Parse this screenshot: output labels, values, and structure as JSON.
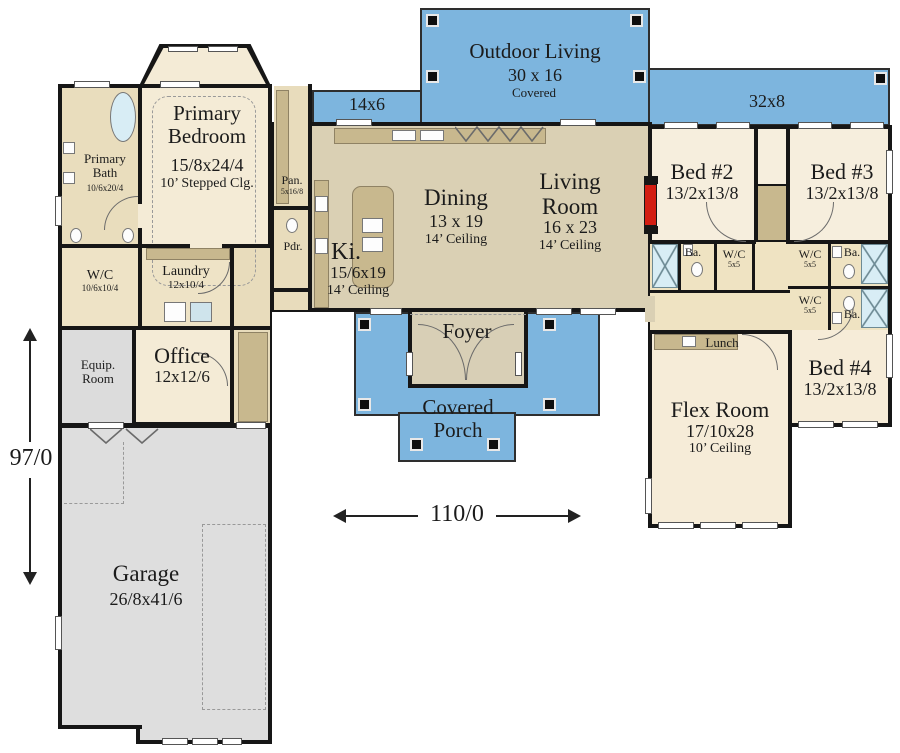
{
  "rooms": {
    "outdoor_living": {
      "name": "Outdoor Living",
      "dims": "30 x 16",
      "note": "Covered"
    },
    "porch_left": {
      "dims": "14x6"
    },
    "porch_right": {
      "dims": "32x8"
    },
    "primary_bedroom": {
      "name": "Primary Bedroom",
      "dims": "15/8x24/4",
      "ceiling": "10’ Stepped Clg."
    },
    "primary_bath": {
      "name": "Primary Bath",
      "dims": "10/6x20/4"
    },
    "pantry": {
      "name": "Pan.",
      "dims": "5x16/8"
    },
    "powder": {
      "name": "Pdr."
    },
    "kitchen": {
      "name": "Ki.",
      "dims": "15/6x19",
      "ceiling": "14’ Ceiling"
    },
    "dining": {
      "name": "Dining",
      "dims": "13 x 19",
      "ceiling": "14’ Ceiling"
    },
    "living": {
      "name": "Living Room",
      "dims": "16 x 23",
      "ceiling": "14’ Ceiling"
    },
    "bed2": {
      "name": "Bed #2",
      "dims": "13/2x13/8"
    },
    "bed3": {
      "name": "Bed #3",
      "dims": "13/2x13/8"
    },
    "bed4": {
      "name": "Bed #4",
      "dims": "13/2x13/8"
    },
    "bath_label": "Ba.",
    "wc_small": {
      "name": "W/C",
      "dims": "5x5"
    },
    "walk_in_closet": {
      "name": "W/C",
      "dims": "10/6x10/4"
    },
    "laundry": {
      "name": "Laundry",
      "dims": "12x10/4"
    },
    "equip": {
      "name": "Equip. Room"
    },
    "office": {
      "name": "Office",
      "dims": "12x12/6"
    },
    "foyer": {
      "name": "Foyer"
    },
    "covered_porch": {
      "name": "Covered Porch"
    },
    "lunch": {
      "name": "Lunch"
    },
    "flex": {
      "name": "Flex Room",
      "dims": "17/10x28",
      "ceiling": "10’ Ceiling"
    },
    "garage": {
      "name": "Garage",
      "dims": "26/8x41/6"
    }
  },
  "dimensions": {
    "vertical": "97/0",
    "horizontal": "110/0"
  },
  "colors": {
    "porch_blue": "#7db5de",
    "room_cream": "#f4ebd6",
    "great_room_tan": "#dad0b4",
    "cabinet_tan": "#c8b88e",
    "garage_gray": "#dedede",
    "wall_black": "#161616",
    "fireplace_red": "#d21d12",
    "fixture_blue": "#d8edf5"
  }
}
